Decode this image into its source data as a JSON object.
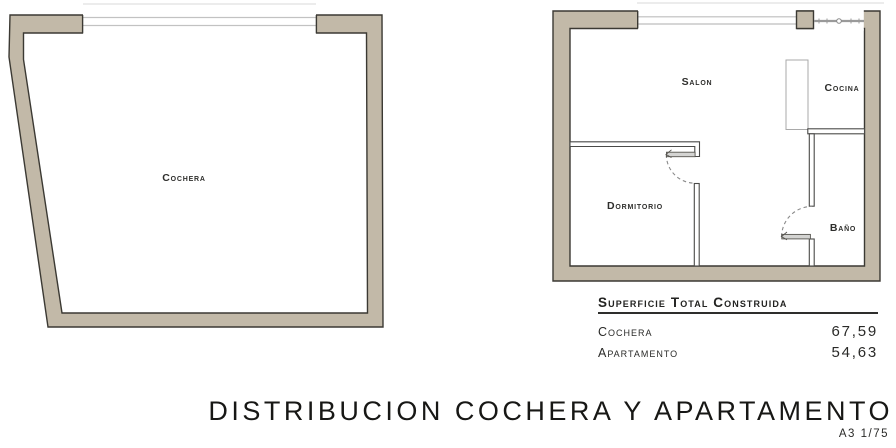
{
  "plans": {
    "cochera": {
      "room_label": "Cochera"
    },
    "apartment": {
      "rooms": {
        "salon": "Salon",
        "cocina": "Cocina",
        "dormitorio": "Dormitorio",
        "bano": "Baño"
      }
    }
  },
  "summary": {
    "heading": "Superficie Total Construida",
    "rows": [
      {
        "label": "Cochera",
        "value": "67,59"
      },
      {
        "label": "Apartamento",
        "value": "54,63"
      }
    ]
  },
  "title_block": {
    "title": "DISTRIBUCION COCHERA Y APARTAMENTO",
    "scale_note": "A3 1/75"
  },
  "colors": {
    "wall_fill": "#c2b9a8",
    "wall_outline": "#3b3933",
    "interior_wall": "#4a4a48",
    "window_line": "#bdbdbd",
    "background": "#ffffff",
    "text": "#2a2a28"
  }
}
